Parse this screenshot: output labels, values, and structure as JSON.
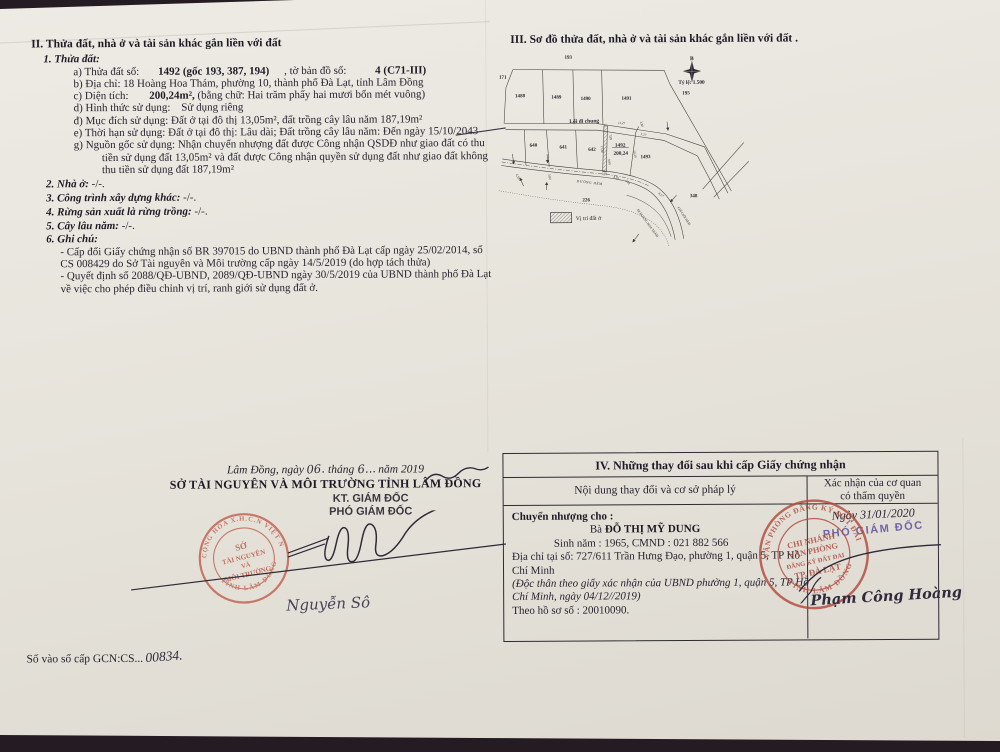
{
  "colors": {
    "paper": "#e7e4dc",
    "background": "#241c22",
    "ink": "#262330",
    "stamp_red": "#b44a3c",
    "stamp_red_light": "#c05a48",
    "role_purple": "#5a4fa3"
  },
  "sec2": {
    "title": "II. Thửa đất, nhà ở và tài sản khác gắn liền với đất",
    "sub1": "1. Thửa đất:",
    "a_label": "a) Thửa đất số:",
    "a_value": "1492 (gốc 193, 387, 194)",
    "a_label2": ", tờ bản đồ số:",
    "a_value2": "4 (C71-III)",
    "b_label": "b) Địa chỉ:",
    "b_value": "18 Hoàng Hoa Thám, phường 10, thành phố Đà Lạt, tỉnh Lâm Đồng",
    "c_label": "c) Diện tích:",
    "c_value": "200,24m²,",
    "c_note": "(bằng chữ: Hai trăm phẩy hai mươi bốn mét vuông)",
    "d_label": "d) Hình thức sử dụng:",
    "d_value": "Sử dụng riêng",
    "dd_label": "đ) Mục đích sử dụng:",
    "dd_value": "Đất ở tại đô thị 13,05m², đất trồng cây lâu năm 187,19m²",
    "e_label": "e) Thời hạn sử dụng:",
    "e_value": "Đất ở tại đô thị: Lâu dài; Đất trồng cây lâu năm: Đến ngày 15/10/2043",
    "g_label": "g) Nguồn gốc sử dụng:",
    "g_value": "Nhận chuyển nhượng đất được Công nhận QSDĐ như giao đất có thu tiền sử dụng đất 13,05m² và đất được Công nhận quyền sử dụng đất như giao đất không thu tiền sử dụng đất 187,19m²",
    "i2_label": "2. Nhà ở:",
    "i2_value": "-/-.",
    "i3_label": "3. Công trình xây dựng khác:",
    "i3_value": "-/-.",
    "i4_label": "4. Rừng sản xuất là rừng trồng:",
    "i4_value": "-/-.",
    "i5_label": "5. Cây lâu năm:",
    "i5_value": "-/-.",
    "i6_label": "6. Ghi chú:",
    "note1": "- Cấp đổi Giấy chứng nhận số BR 397015 do UBND thành phố Đà Lạt cấp ngày 25/02/2014, số CS 008429 do Sở Tài nguyên và Môi trường cấp ngày 14/5/2019 (do hợp tách thửa)",
    "note2": "- Quyết định số 2088/QĐ-UBND, 2089/QĐ-UBND ngày 30/5/2019 của UBND thành phố Đà Lạt về việc cho phép điều chỉnh vị trí, ranh giới sử dụng đất ở."
  },
  "signoff": {
    "date_prefix": "Lâm Đồng, ngày",
    "date_day": "06.",
    "date_mid": "tháng",
    "date_month": "6...",
    "date_suffix": "năm 2019",
    "org": "SỞ TÀI NGUYÊN VÀ MÔI TRƯỜNG TỈNH LÂM ĐỒNG",
    "kt": "KT. GIÁM ĐỐC",
    "role": "PHÓ GIÁM ĐỐC",
    "signer": "Nguyễn Sô",
    "stamp_top": "CỘNG HÒA X.H.C.N VIỆT NAM",
    "stamp_bottom": "TỈNH LÂM ĐỒNG",
    "stamp_c1": "SỞ",
    "stamp_c2": "TÀI NGUYÊN",
    "stamp_c3": "VÀ",
    "stamp_c4": "MÔI TRƯỜNG"
  },
  "gcn": {
    "label": "Số vào sổ cấp GCN:CS...",
    "number": "00834."
  },
  "map": {
    "title": "III. Sơ đồ thửa đất, nhà ở và tài sản khác gắn liền với đất .",
    "compass": "B",
    "scale": "Tỷ lệ: 1.500",
    "legend": "Vị trí đất ở",
    "labels": {
      "p193": "193",
      "p171": "171",
      "p195": "195",
      "p1488": "1488",
      "p1489": "1489",
      "p1490": "1490",
      "p1491": "1491",
      "p640": "640",
      "p641": "641",
      "p642": "642",
      "p1492": "1492",
      "area1492": "200,24",
      "p1493": "1493",
      "p226": "226",
      "p348": "348",
      "loi": "Lối đi chung",
      "hem": "ĐƯỜNG HẺM",
      "dihoang": "ĐI HOÀNG HOA THÁM",
      "chigioi": "CHỈ GIỚI HẺM"
    },
    "dims": {
      "d1": "11,27",
      "d2": "3,80",
      "d3": "3,27",
      "d4": "7,89",
      "d5": "17,80",
      "d6": "9,99",
      "d7": "20,30",
      "d8": "1,37",
      "d9": "4,56",
      "d10": "2,82",
      "d11": "4,17",
      "d12": "4,50",
      "d13": "3,80"
    }
  },
  "sec4": {
    "title": "IV. Những thay đổi sau khi cấp Giấy chứng nhận",
    "col_left": "Nội dung thay đổi và cơ sở pháp lý",
    "col_right_l1": "Xác nhận của cơ quan",
    "col_right_l2": "có thẩm quyền",
    "transfer_label": "Chuyển nhượng cho :",
    "name_prefix": "Bà",
    "name": "ĐỖ THỊ MỸ DUNG",
    "birth": "Sinh năm : 1965, CMND : 021 882 566",
    "address": "Địa chỉ tại số: 727/611 Trần Hưng Đạo, phường 1, quận 5, TP Hồ Chí Minh",
    "single_note": "(Độc thân theo giấy xác nhận của UBND phường 1, quận 5, TP Hồ Chí Minh, ngày 04/12//2019)",
    "file": "Theo hồ sơ số : 20010090.",
    "date": "Ngày 31/01/2020",
    "role": "PHÓ GIÁM ĐỐC",
    "signer": "Phạm Công Hoàng",
    "stamp_top": "VĂN PHÒNG ĐĂNG KÝ ĐẤT ĐAI",
    "stamp_bottom": "TỈNH LÂM ĐỒNG",
    "stamp_c1": "CHI NHÁNH",
    "stamp_c2": "VĂN PHÒNG",
    "stamp_c3": "ĐĂNG KÝ ĐẤT ĐAI",
    "stamp_c4": "TP. ĐÀ LẠT"
  }
}
